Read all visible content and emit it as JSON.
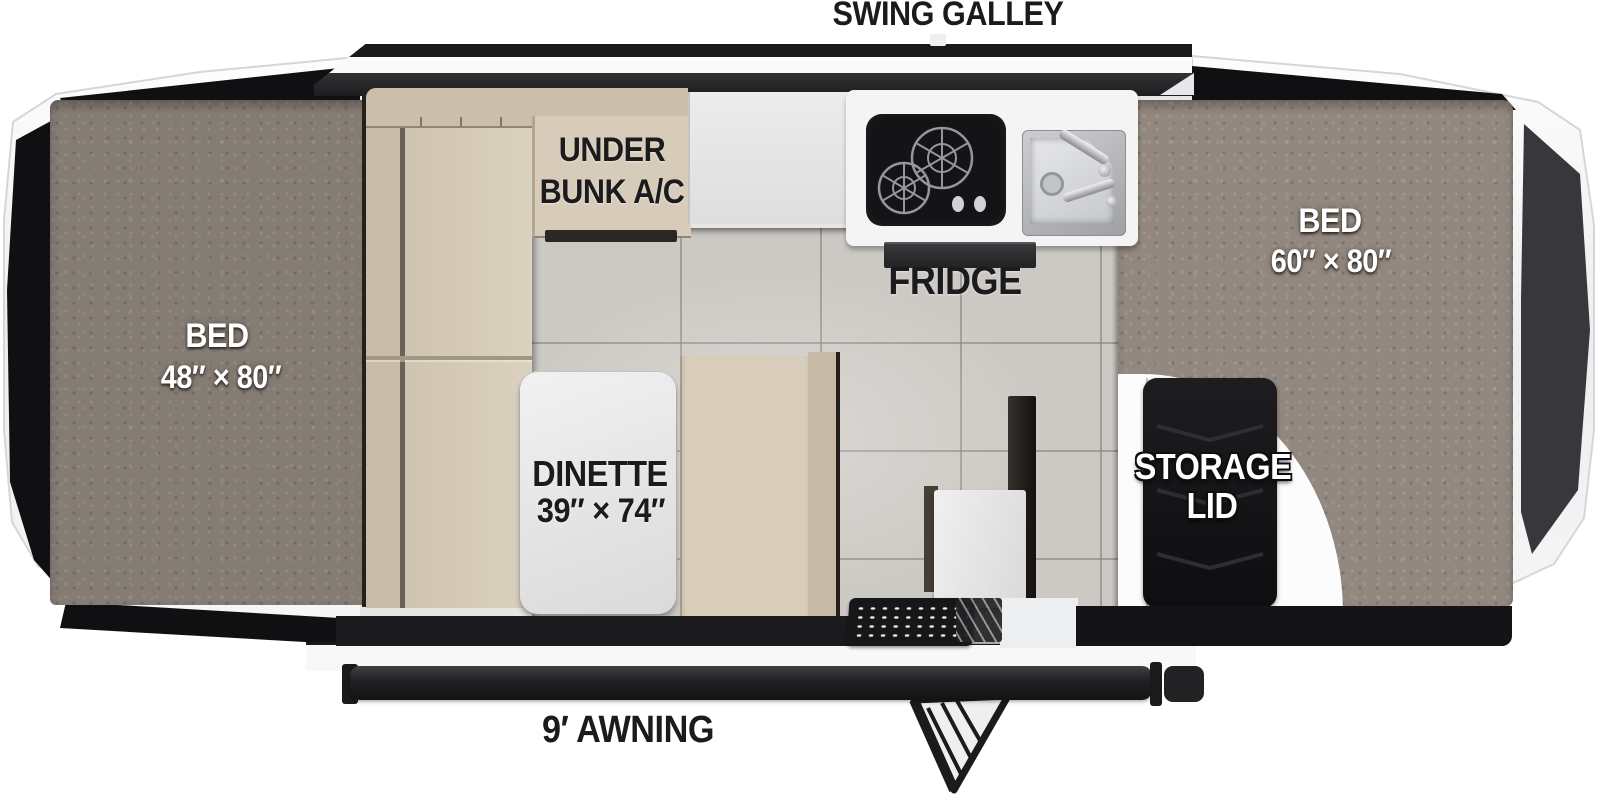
{
  "floorplan": {
    "galley": {
      "label": "SWING GALLEY",
      "fridge": "FRIDGE"
    },
    "bunk_ac": {
      "line1": "UNDER",
      "line2": "BUNK A/C"
    },
    "bed_front": {
      "line1": "BED",
      "line2": "48″ × 80″"
    },
    "bed_rear": {
      "line1": "BED",
      "line2": "60″ × 80″"
    },
    "dinette": {
      "line1": "DINETTE",
      "line2": "39″ × 74″"
    },
    "storage": {
      "line1": "STORAGE",
      "line2": "LID"
    },
    "awning": {
      "label": "9′ AWNING"
    }
  },
  "colors": {
    "carpet": "#8b8279",
    "cushion": "#d6cbb8",
    "tile_floor": "#ccc9c4",
    "counter": "#f4f4f5",
    "appliance_black": "#141417",
    "shell_white": "#f4f4f5",
    "tent_fabric_black": "#101012"
  }
}
